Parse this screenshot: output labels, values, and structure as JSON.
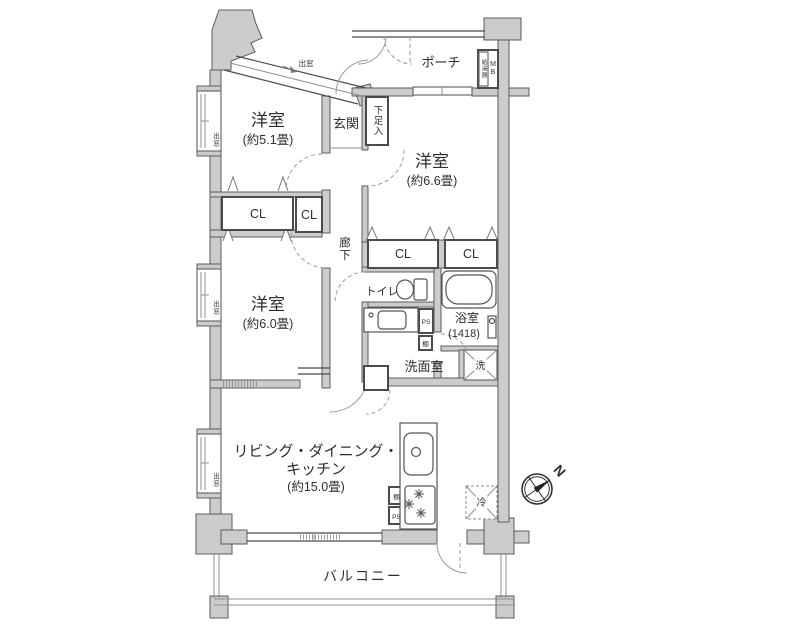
{
  "rooms": {
    "western_room_small": {
      "name": "洋室",
      "size": "(約5.1畳)"
    },
    "western_room_right": {
      "name": "洋室",
      "size": "(約6.6畳)"
    },
    "western_room_mid": {
      "name": "洋室",
      "size": "(約6.0畳)"
    },
    "ldk": {
      "line1": "リビング・ダイニング・",
      "line2": "キッチン",
      "size": "(約15.0畳)"
    },
    "porch": "ポーチ",
    "entrance": "玄関",
    "shoe_box": "下足入",
    "hallway": "廊下",
    "toilet": "トイレ",
    "bathroom": {
      "name": "浴室",
      "size": "(1418)"
    },
    "washroom": "洗面室",
    "balcony": "バルコニー"
  },
  "fixtures": {
    "closet": "CL",
    "washer": "洗",
    "fridge": "冷",
    "shelf": "棚",
    "pipe_space": "PS",
    "meter_box": "MB",
    "water_heater": "給湯器",
    "bay_window": "出窓"
  },
  "compass": {
    "north": "N"
  },
  "colors": {
    "wall_fill": "#cccccd",
    "wall_stroke": "#5b5c5e",
    "line": "#4b4b4b",
    "light_line": "#8f8f8f",
    "text": "#2e2e2e",
    "background": "#ffffff"
  }
}
